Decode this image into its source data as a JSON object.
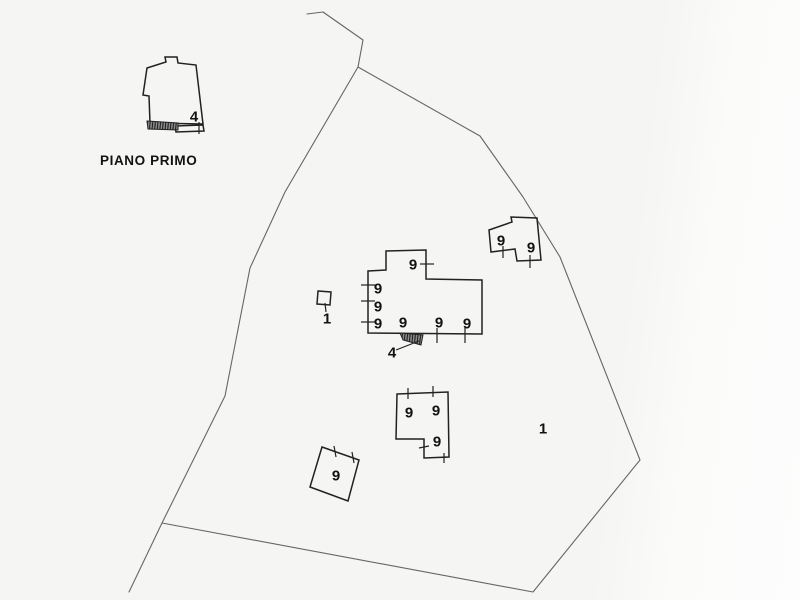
{
  "document": {
    "floor_title": "PIANO PRIMO"
  },
  "colors": {
    "boundary": "#666664",
    "outline": "#222222",
    "label": "#121212",
    "hatch_base": "#8f8f8f",
    "hatch_line": "#1a1a1a"
  },
  "drawing": {
    "width": 800,
    "height": 600,
    "boundaries": [
      {
        "name": "parcel-boundary-west",
        "points": [
          [
            307,
            14
          ],
          [
            323,
            12
          ],
          [
            363,
            40
          ],
          [
            358,
            67
          ],
          [
            285,
            192
          ],
          [
            250,
            268
          ],
          [
            225,
            396
          ],
          [
            162,
            523
          ],
          [
            129,
            592
          ]
        ]
      },
      {
        "name": "parcel-boundary-east",
        "points": [
          [
            358,
            67
          ],
          [
            480,
            136
          ],
          [
            523,
            197
          ],
          [
            560,
            257
          ],
          [
            640,
            460
          ],
          [
            533,
            592
          ],
          [
            162,
            523
          ]
        ]
      }
    ],
    "buildings": [
      {
        "name": "building-first-floor-outline",
        "points": [
          [
            147,
            68
          ],
          [
            166,
            62
          ],
          [
            165,
            57
          ],
          [
            177,
            57
          ],
          [
            178,
            63
          ],
          [
            196,
            65
          ],
          [
            203,
            124
          ],
          [
            150,
            123
          ],
          [
            149,
            96
          ],
          [
            143,
            95
          ]
        ]
      },
      {
        "name": "building-first-floor-balcony",
        "points": [
          [
            175,
            126
          ],
          [
            203,
            125
          ],
          [
            204,
            131
          ],
          [
            176,
            132
          ]
        ]
      },
      {
        "name": "building-central",
        "points": [
          [
            386,
            251
          ],
          [
            426,
            250
          ],
          [
            426,
            279
          ],
          [
            482,
            280
          ],
          [
            482,
            334
          ],
          [
            368,
            333
          ],
          [
            368,
            271
          ],
          [
            386,
            270
          ]
        ]
      },
      {
        "name": "building-northeast",
        "points": [
          [
            489,
            230
          ],
          [
            512,
            222
          ],
          [
            511,
            217
          ],
          [
            537,
            218
          ],
          [
            541,
            260
          ],
          [
            517,
            261
          ],
          [
            515,
            249
          ],
          [
            491,
            252
          ]
        ]
      },
      {
        "name": "building-south",
        "points": [
          [
            397,
            394
          ],
          [
            448,
            392
          ],
          [
            449,
            457
          ],
          [
            424,
            458
          ],
          [
            424,
            439
          ],
          [
            396,
            439
          ]
        ]
      },
      {
        "name": "building-southwest",
        "points": [
          [
            322,
            447
          ],
          [
            359,
            460
          ],
          [
            348,
            501
          ],
          [
            310,
            487
          ]
        ]
      },
      {
        "name": "small-structure",
        "points": [
          [
            318,
            291
          ],
          [
            331,
            292
          ],
          [
            330,
            305
          ],
          [
            317,
            304
          ]
        ]
      }
    ],
    "hatched": [
      {
        "name": "hatched-terrace-strip",
        "points": [
          [
            147,
            121
          ],
          [
            178,
            123
          ],
          [
            178,
            130
          ],
          [
            148,
            129
          ]
        ]
      },
      {
        "name": "external-stairs",
        "points": [
          [
            400,
            333
          ],
          [
            423,
            335
          ],
          [
            421,
            345
          ],
          [
            403,
            340
          ]
        ]
      }
    ],
    "leaders": [
      {
        "name": "leader-line-stairs",
        "points": [
          [
            396,
            350
          ],
          [
            419,
            341
          ]
        ]
      }
    ],
    "ticks": [
      [
        199,
        122,
        199,
        134
      ],
      [
        361,
        285,
        375,
        285
      ],
      [
        361,
        301,
        375,
        301
      ],
      [
        361,
        322,
        375,
        322
      ],
      [
        420,
        264,
        434,
        264
      ],
      [
        437,
        328,
        437,
        343
      ],
      [
        465,
        328,
        465,
        343
      ],
      [
        503,
        246,
        503,
        258
      ],
      [
        530,
        255,
        530,
        268
      ],
      [
        408,
        388,
        408,
        399
      ],
      [
        433,
        386,
        433,
        397
      ],
      [
        419,
        448,
        429,
        446
      ],
      [
        444,
        453,
        444,
        463
      ],
      [
        334,
        446,
        336,
        457
      ],
      [
        352,
        452,
        354,
        463
      ],
      [
        325,
        303,
        326,
        312
      ]
    ],
    "labels": [
      {
        "text": "4",
        "x": 194,
        "y": 116,
        "size": 15
      },
      {
        "text": "9",
        "x": 413,
        "y": 264,
        "size": 15
      },
      {
        "text": "9",
        "x": 378,
        "y": 288,
        "size": 15
      },
      {
        "text": "9",
        "x": 378,
        "y": 306,
        "size": 15
      },
      {
        "text": "9",
        "x": 378,
        "y": 323,
        "size": 15
      },
      {
        "text": "9",
        "x": 403,
        "y": 322,
        "size": 15
      },
      {
        "text": "9",
        "x": 439,
        "y": 322,
        "size": 15
      },
      {
        "text": "9",
        "x": 467,
        "y": 323,
        "size": 15
      },
      {
        "text": "4",
        "x": 392,
        "y": 352,
        "size": 15
      },
      {
        "text": "1",
        "x": 327,
        "y": 318,
        "size": 15
      },
      {
        "text": "9",
        "x": 501,
        "y": 240,
        "size": 15
      },
      {
        "text": "9",
        "x": 531,
        "y": 247,
        "size": 15
      },
      {
        "text": "9",
        "x": 409,
        "y": 412,
        "size": 15
      },
      {
        "text": "9",
        "x": 436,
        "y": 410,
        "size": 15
      },
      {
        "text": "9",
        "x": 437,
        "y": 441,
        "size": 15
      },
      {
        "text": "9",
        "x": 336,
        "y": 475,
        "size": 15
      },
      {
        "text": "1",
        "x": 543,
        "y": 428,
        "size": 15
      },
      {
        "text": "PIANO PRIMO",
        "x": 100,
        "y": 160,
        "size": 13.5,
        "anchor": "start",
        "spacing": 0.6,
        "name": "floor-title"
      }
    ]
  }
}
